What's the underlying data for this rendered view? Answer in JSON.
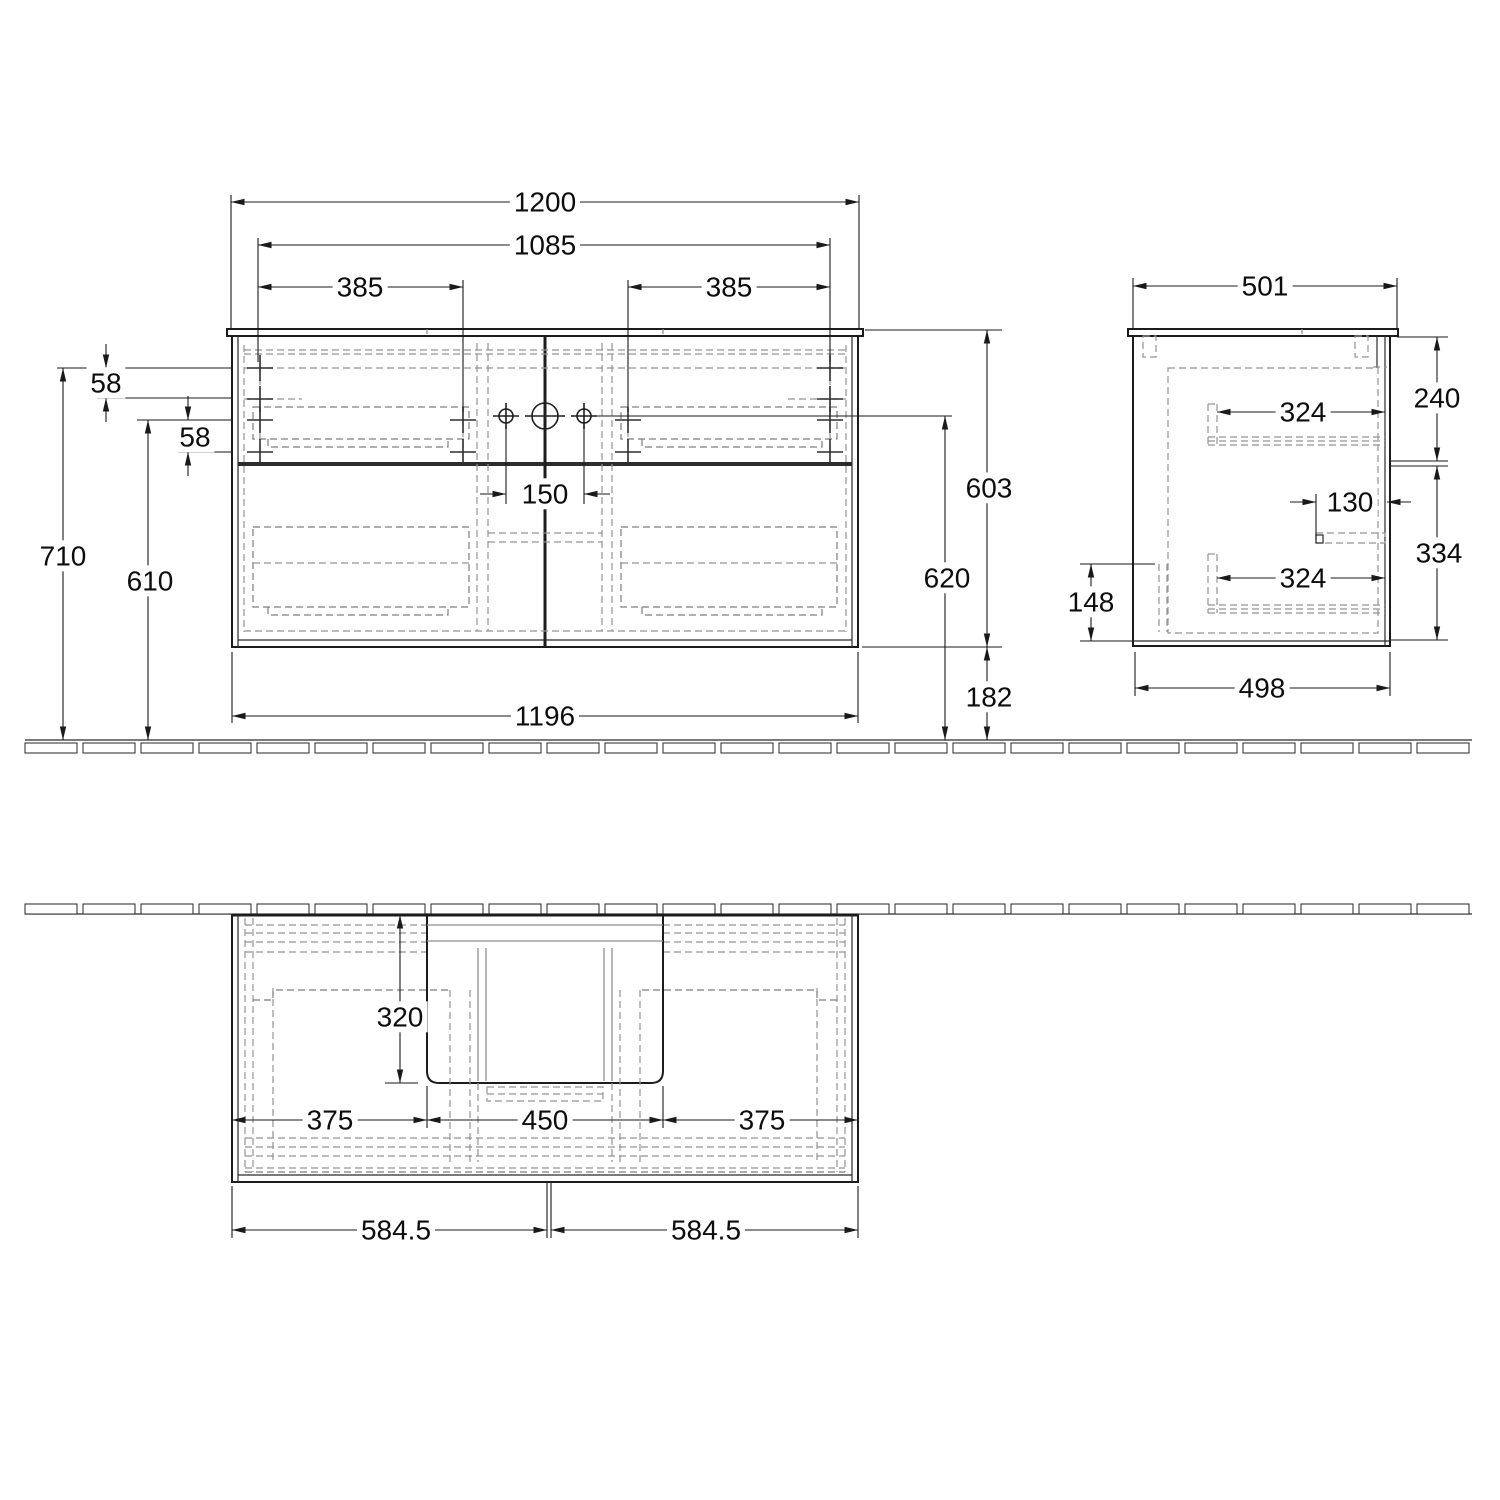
{
  "drawing": {
    "title": "vanity-unit-dimension-drawing",
    "units": "mm",
    "views": {
      "front": {
        "dims": {
          "overall_width": "1200",
          "hole_span": "1085",
          "hole_offset_left": "385",
          "hole_offset_right": "385",
          "top_hole_row_offset": "58",
          "second_hole_row_offset": "58",
          "overall_height": "710",
          "lower_row_height": "610",
          "faucet_hole_spacing": "150",
          "body_width": "1196",
          "body_height": "603",
          "hole_center_height": "620",
          "clearance_below": "182"
        }
      },
      "side": {
        "dims": {
          "overall_depth": "501",
          "upper_drawer_front_height": "240",
          "upper_runner_depth": "324",
          "handle_recess_depth": "130",
          "lower_drawer_front_height": "334",
          "lower_runner_depth": "324",
          "siphon_cutout_height": "148",
          "body_depth": "498"
        }
      },
      "plan": {
        "dims": {
          "basin_cutout_depth": "320",
          "left_offset": "375",
          "basin_cutout_width": "450",
          "right_offset": "375",
          "center_left": "584.5",
          "center_right": "584.5"
        }
      }
    }
  }
}
